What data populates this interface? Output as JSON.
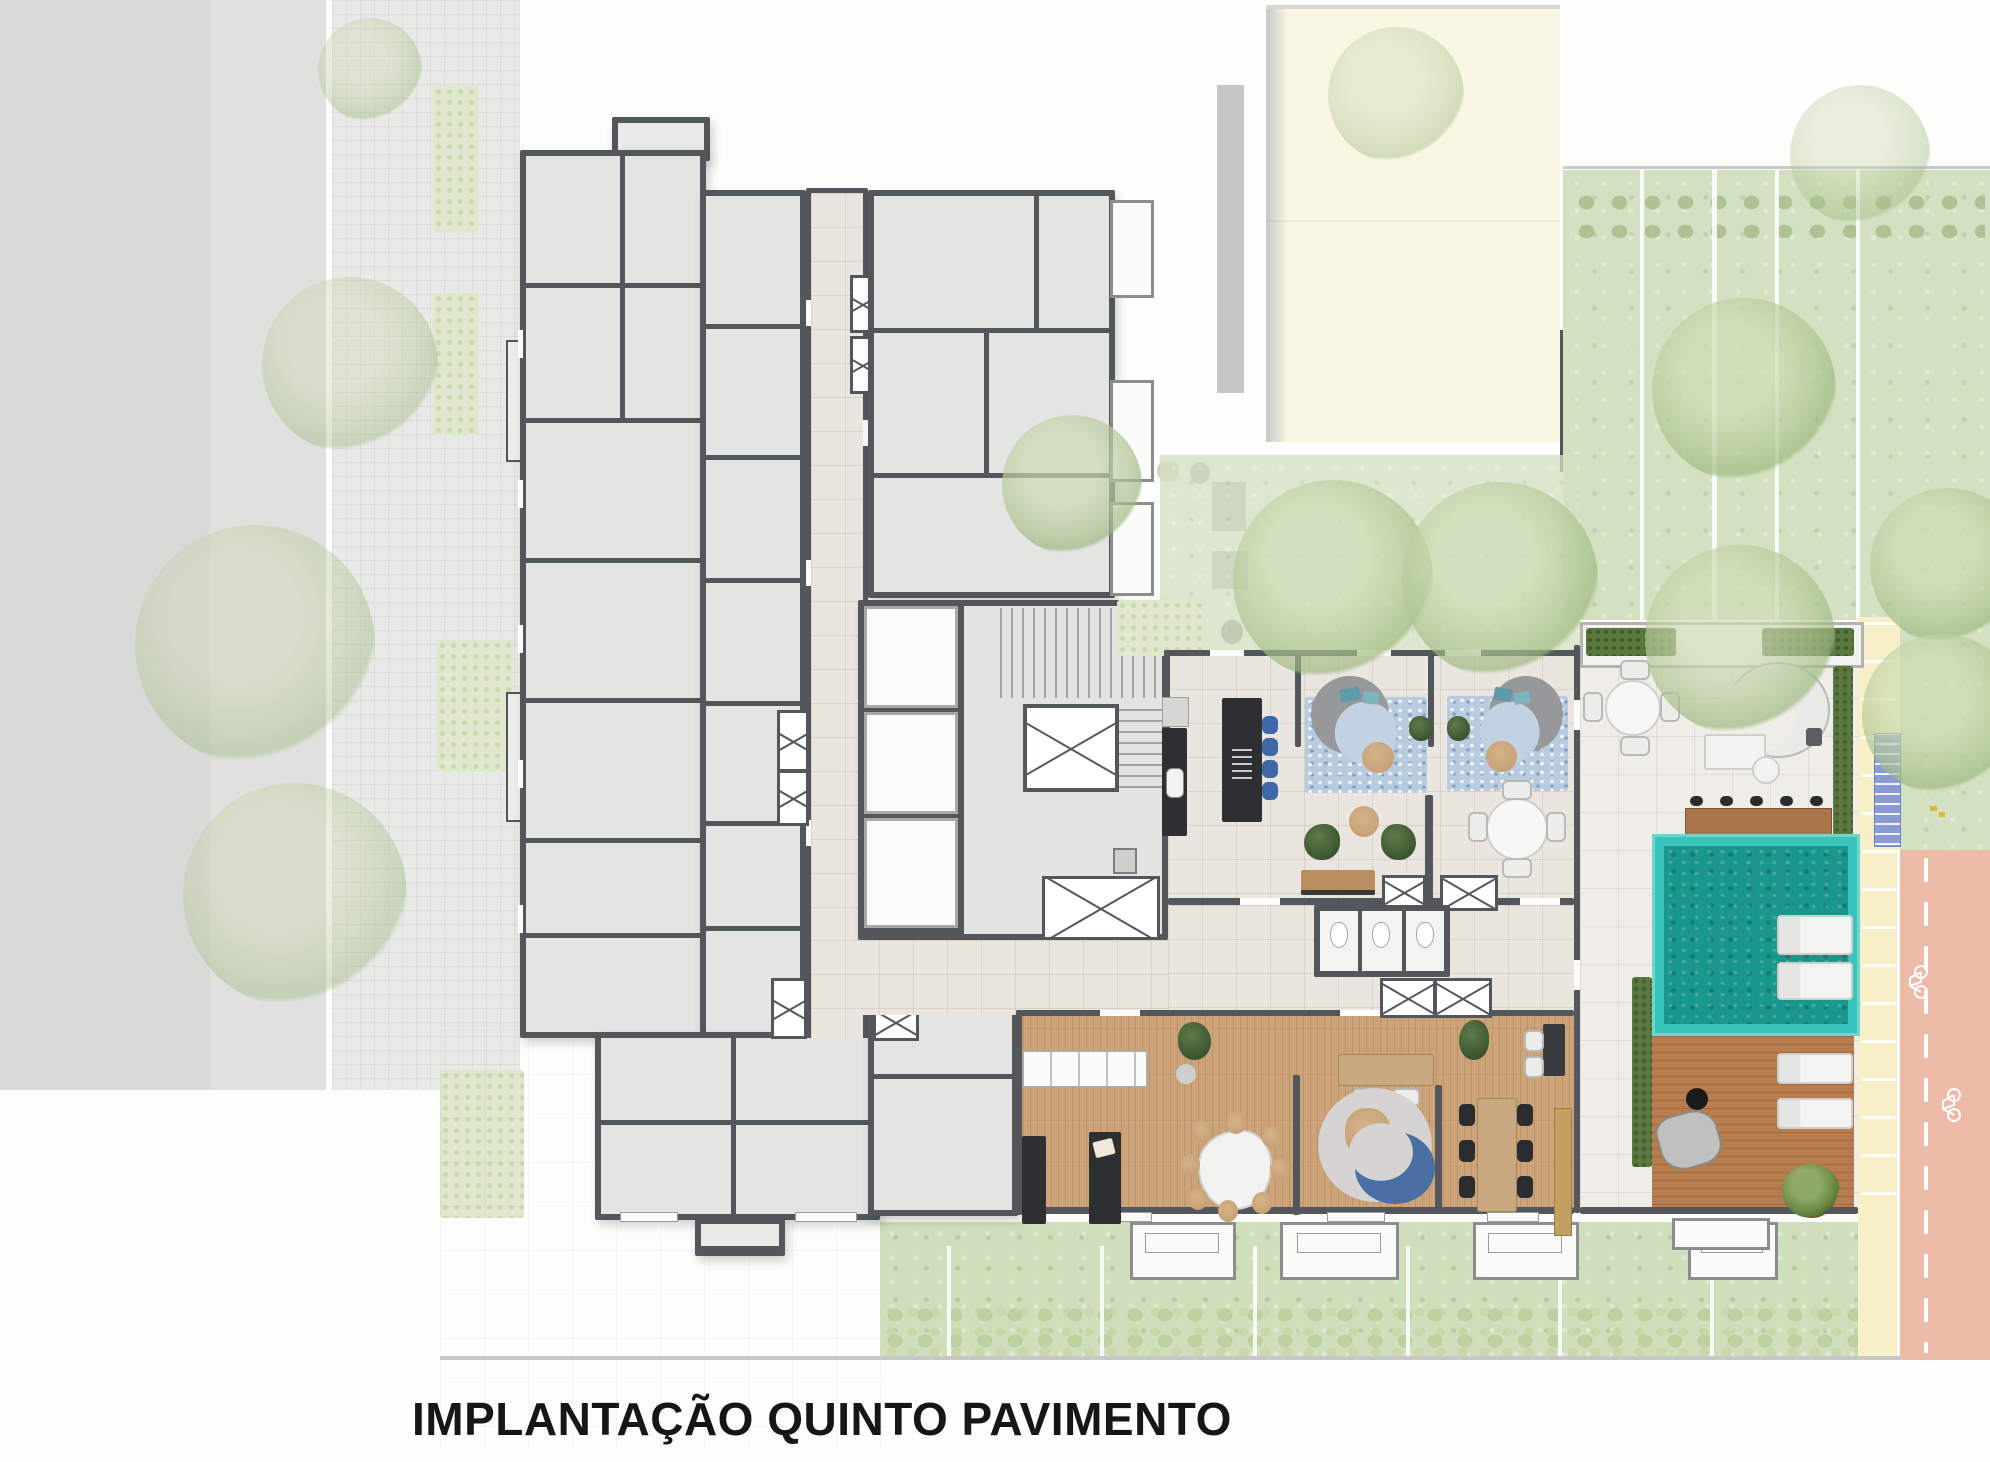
{
  "title": "IMPLANTAÇÃO QUINTO PAVIMENTO",
  "palette": {
    "street": "#d9d9d8",
    "sidewalk_tile": "#e9e9e7",
    "building_wall": "#53565a",
    "unit_floor": "#e4e4e3",
    "corridor_tile": "#eae6df",
    "terrace_tile": "#efede7",
    "gourmet_wood": "#cda37a",
    "deck_wood": "#b77d4f",
    "pool_edge": "#38c4ba",
    "pool_water": "#1a978d",
    "lawn": "#d3e0c1",
    "hedge": "#5a7740",
    "planter_bed": "#dfe7cd",
    "neighbor_roof": "#faf6e4",
    "road": "#edbba8",
    "walkway_strip": "#f6efc8",
    "bike_rack_blue": "#8a9bd8",
    "rug_blue": "#b9cbdf",
    "stool_blue": "#3e68a8",
    "furniture_dark": "#2e2f31",
    "armchair_green": "#44603a",
    "title_text": "#161617"
  },
  "icons": {
    "bike_lane_icon": "bicycle-outline",
    "duct_shaft_icon": "crossed-box",
    "stair_icon": "treads"
  }
}
